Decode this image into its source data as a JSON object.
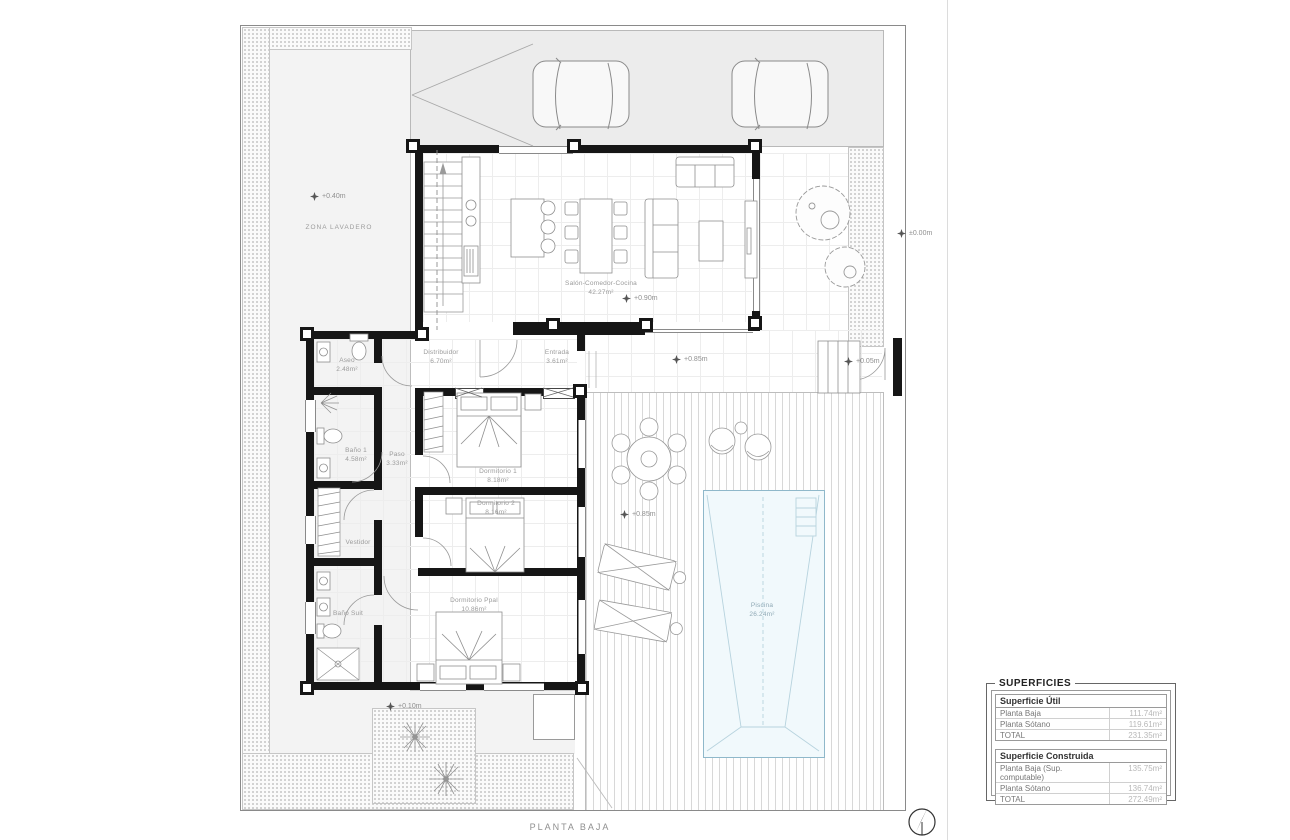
{
  "plan": {
    "title": "PLANTA BAJA",
    "zone_label": "ZONA LAVADERO",
    "rooms": {
      "salon": {
        "name": "Salón-Comedor-Cocina",
        "area": "42.27m²"
      },
      "distribuidor": {
        "name": "Distribuidor",
        "area": "6.70m²"
      },
      "entrada": {
        "name": "Entrada",
        "area": "3.61m²"
      },
      "aseo": {
        "name": "Aseo",
        "area": "2.48m²"
      },
      "bano1": {
        "name": "Baño 1",
        "area": "4.58m²"
      },
      "paso": {
        "name": "Paso",
        "area": "3.33m²"
      },
      "dormitorio1": {
        "name": "Dormitorio 1",
        "area": "8.18m²"
      },
      "dormitorio2": {
        "name": "Dormitorio 2",
        "area": "8.16m²"
      },
      "vestidor": {
        "name": "Vestidor"
      },
      "banosuit": {
        "name": "Baño Suit"
      },
      "dormppal": {
        "name": "Dormitorio Ppal",
        "area": "10.86m²"
      },
      "piscina": {
        "name": "Piscina",
        "area": "26.24m²"
      }
    },
    "levels": [
      "+0.40m",
      "+0.90m",
      "±0.00m",
      "+0.85m",
      "+0.05m",
      "+0.85m",
      "+0.10m"
    ]
  },
  "superficies": {
    "title": "SUPERFICIES",
    "util": {
      "header": "Superficie Útil",
      "rows": [
        {
          "label": "Planta Baja",
          "value": "111.74m²"
        },
        {
          "label": "Planta Sótano",
          "value": "119.61m²"
        },
        {
          "label": "TOTAL",
          "value": "231.35m²"
        }
      ]
    },
    "construida": {
      "header": "Superficie Construida",
      "rows": [
        {
          "label": "Planta Baja (Sup. computable)",
          "value": "135.75m²"
        },
        {
          "label": "Planta Sótano",
          "value": "136.74m²"
        },
        {
          "label": "TOTAL",
          "value": "272.49m²"
        }
      ]
    }
  }
}
